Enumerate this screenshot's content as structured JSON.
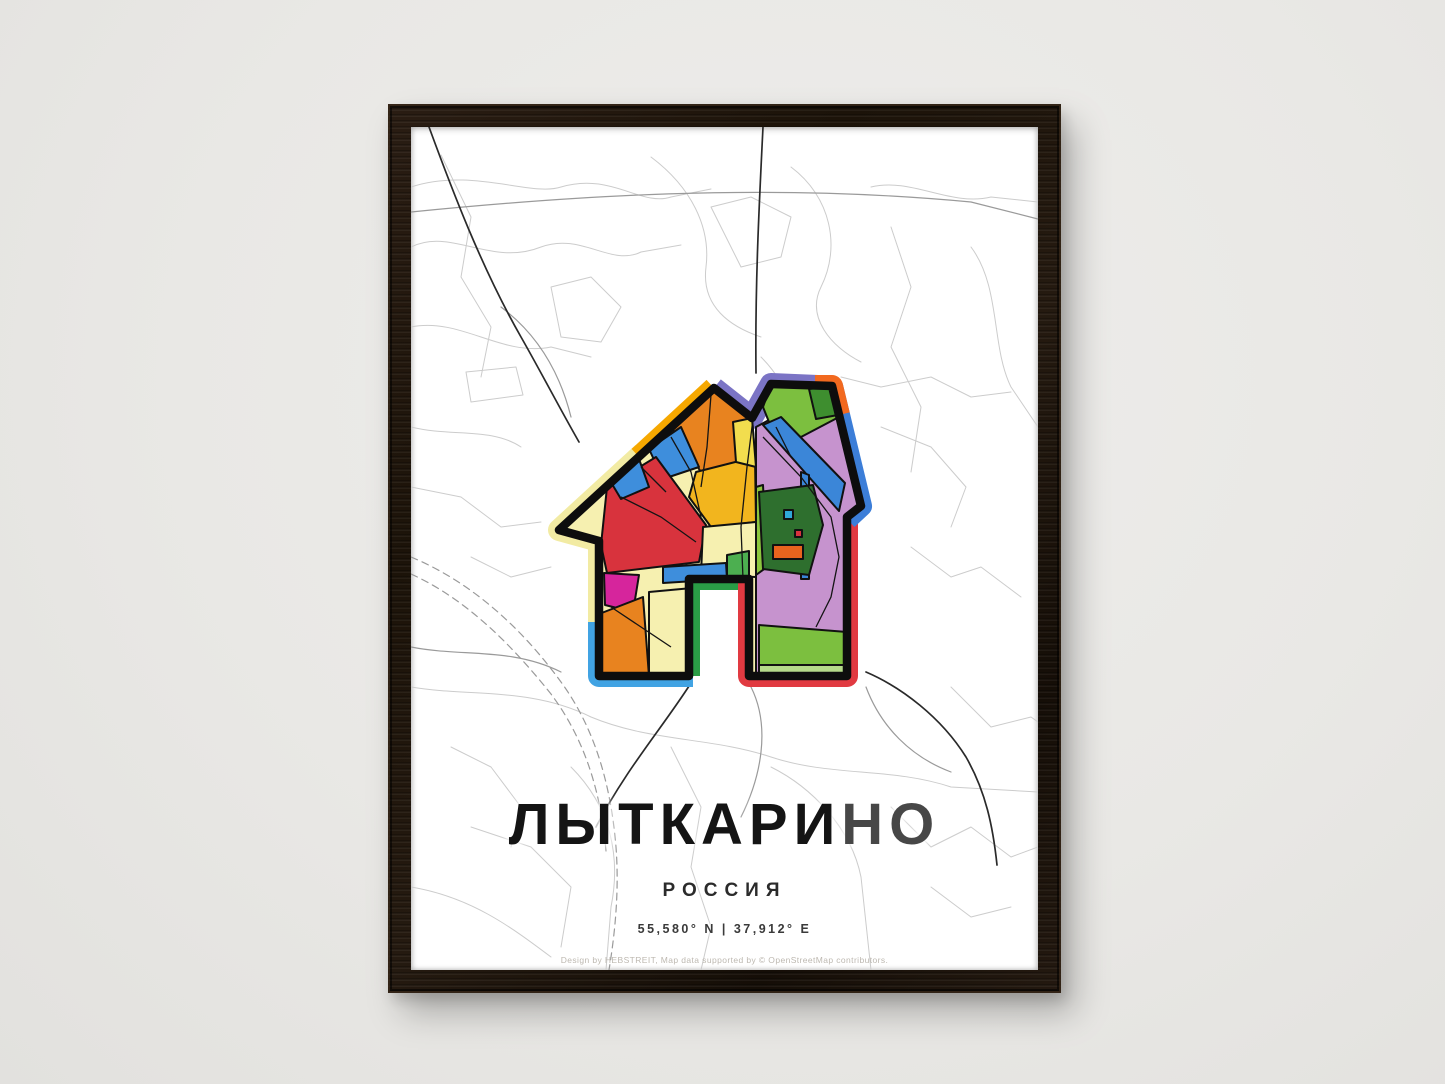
{
  "scene": {
    "wall_color": "#e9e8e5",
    "frame_wood_color": "#1c1309",
    "shadow": "soft drop shadow right/bottom"
  },
  "poster": {
    "title_black": "ЛЫТКАРИ",
    "title_gray": "НО",
    "subtitle": "РОССИЯ",
    "coordinates": "55,580° N | 37,912° E",
    "credit": "Design by HEBSTREIT, Map data supported by © OpenStreetMap contributors.",
    "title_color": "#141414",
    "title_fade_color": "#474747",
    "map_line_colors": {
      "minor": "#cbcbcb",
      "medium": "#9a9a9a",
      "major": "#2a2a2a"
    },
    "icon": {
      "name": "house-map-icon",
      "outline_color": "#0d0d0d",
      "border_colors": [
        "#F6A800",
        "#F2EBA3",
        "#41A3E3",
        "#2A9D46",
        "#E13A41",
        "#3C7ED8",
        "#F2691F",
        "#7B74C5"
      ],
      "fill_colors": [
        "#E8831F",
        "#F2B51E",
        "#D8333D",
        "#3E8EDC",
        "#F6F0B0",
        "#D6259C",
        "#7CBF3F",
        "#3E8E2F",
        "#3B86D8",
        "#C693CE",
        "#2E6F2E",
        "#8CC63F",
        "#B5D98A",
        "#E8641E",
        "#30A8D8",
        "#F2DD4E"
      ]
    }
  }
}
